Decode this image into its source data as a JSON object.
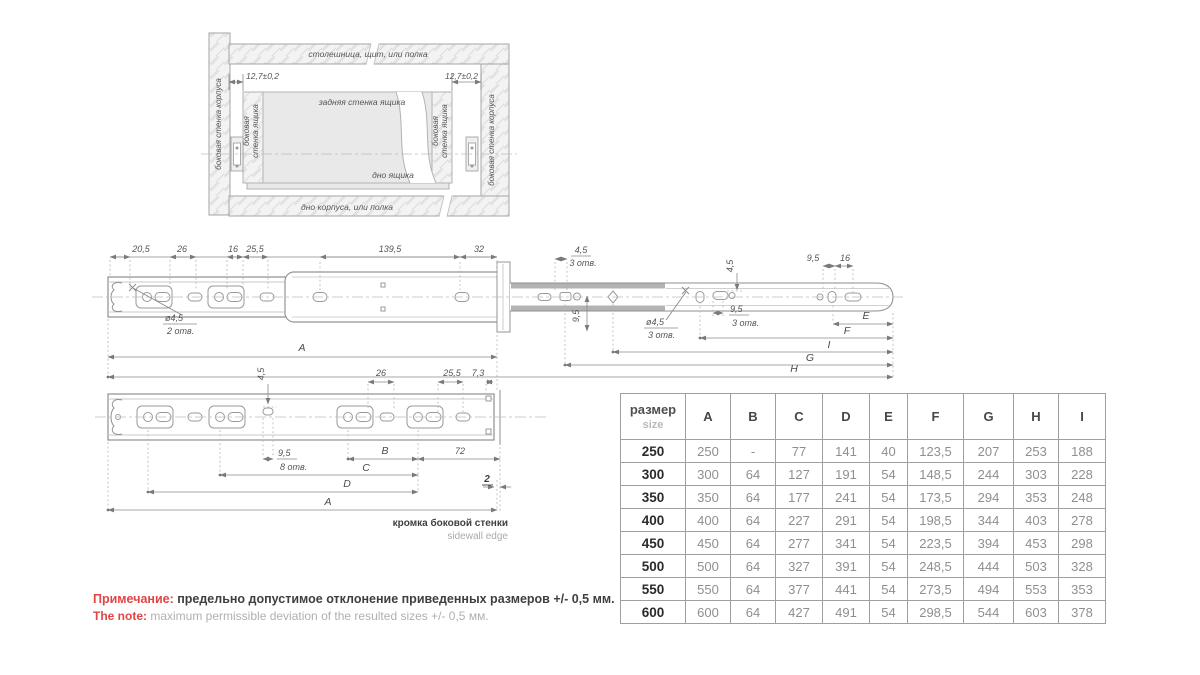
{
  "cabinet_section": {
    "top_panel": "столешница, щит, или полка",
    "bottom_panel": "дно корпуса, или полка",
    "body_side_wall": "боковая стенка корпуса",
    "drawer_side_wall_1": "боковая",
    "drawer_side_wall_2": "стенка ящика",
    "drawer_back": "задняя стенка ящика",
    "drawer_bottom": "дно ящика",
    "offset": "12,7±0,2"
  },
  "dims": {
    "v20_5": "20,5",
    "v26": "26",
    "v16": "16",
    "v25_5": "25,5",
    "v139_5": "139,5",
    "v32": "32",
    "v4_5": "4,5",
    "v9_5": "9,5",
    "v7_3": "7,3",
    "v72": "72",
    "v2": "2",
    "dia4_5": "ø4,5",
    "holes2": "2 отв.",
    "holes3": "3 отв.",
    "holes8": "8 отв.",
    "A": "A",
    "B": "B",
    "C": "C",
    "D": "D",
    "E": "E",
    "F": "F",
    "G": "G",
    "H": "H",
    "I": "I"
  },
  "edge_label": {
    "ru": "кромка боковой стенки",
    "en": "sidewall edge"
  },
  "note": {
    "ru_label": "Примечание:",
    "ru_text": "предельно допустимое отклонение приведенных размеров +/- 0,5 мм.",
    "en_label": "The note:",
    "en_text": "maximum permissible deviation of the resulted sizes +/- 0,5 мм."
  },
  "table": {
    "header": {
      "size_ru": "размер",
      "size_en": "size",
      "cols": [
        "A",
        "B",
        "C",
        "D",
        "E",
        "F",
        "G",
        "H",
        "I"
      ]
    },
    "rows": [
      {
        "size": "250",
        "cells": [
          "250",
          "-",
          "77",
          "141",
          "40",
          "123,5",
          "207",
          "253",
          "188"
        ]
      },
      {
        "size": "300",
        "cells": [
          "300",
          "64",
          "127",
          "191",
          "54",
          "148,5",
          "244",
          "303",
          "228"
        ]
      },
      {
        "size": "350",
        "cells": [
          "350",
          "64",
          "177",
          "241",
          "54",
          "173,5",
          "294",
          "353",
          "248"
        ]
      },
      {
        "size": "400",
        "cells": [
          "400",
          "64",
          "227",
          "291",
          "54",
          "198,5",
          "344",
          "403",
          "278"
        ]
      },
      {
        "size": "450",
        "cells": [
          "450",
          "64",
          "277",
          "341",
          "54",
          "223,5",
          "394",
          "453",
          "298"
        ]
      },
      {
        "size": "500",
        "cells": [
          "500",
          "64",
          "327",
          "391",
          "54",
          "248,5",
          "444",
          "503",
          "328"
        ]
      },
      {
        "size": "550",
        "cells": [
          "550",
          "64",
          "377",
          "441",
          "54",
          "273,5",
          "494",
          "553",
          "353"
        ]
      },
      {
        "size": "600",
        "cells": [
          "600",
          "64",
          "427",
          "491",
          "54",
          "298,5",
          "544",
          "603",
          "378"
        ]
      }
    ]
  },
  "colors": {
    "note_red": "#e24444",
    "text_dark": "#3f3f3f",
    "table_muted": "#8f8f8f",
    "line_gray": "#8a8a8a"
  }
}
